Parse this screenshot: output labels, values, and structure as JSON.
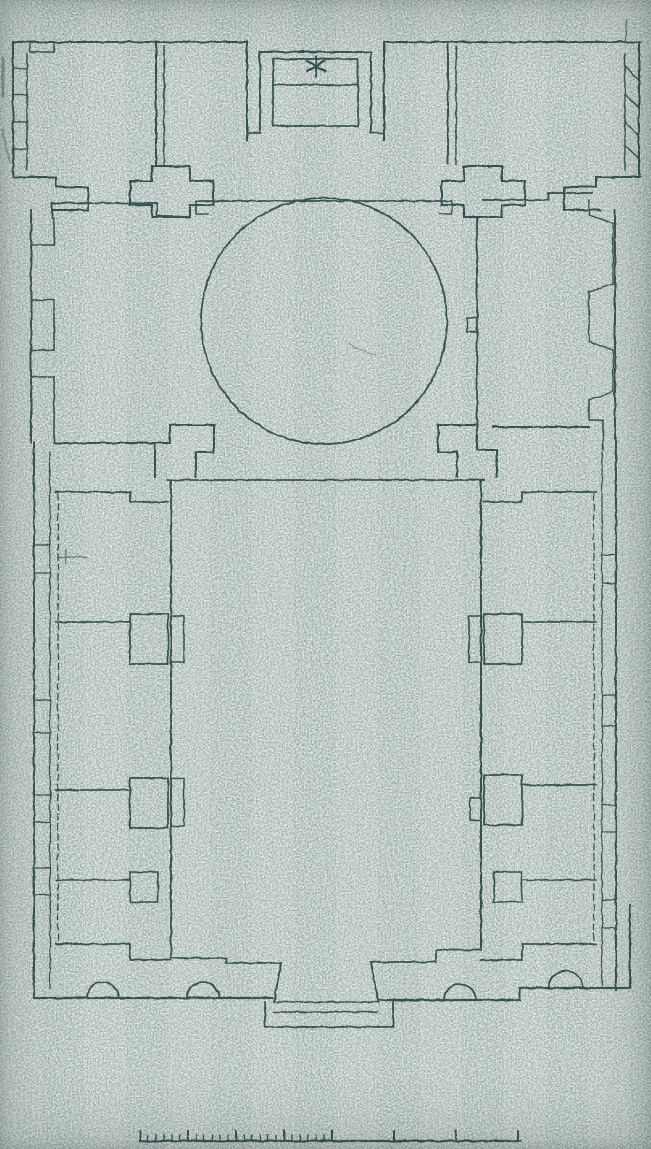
{
  "meta": {
    "document_type": "scanned architectural floor plan",
    "plan_features": "domed hall with projecting apse, courtyard flanked by cell rooms, entrance portal, graphic scale bar",
    "apse_mark_symbol": "asterisk"
  },
  "palette": {
    "paper": "#b4bfbc",
    "paper_light": "#e6ebe8",
    "paper_dark": "#546662",
    "ink": "#2d4845"
  },
  "drawing": {
    "width": 651,
    "height": 1149,
    "elements": [
      {
        "n": "top-wall-left",
        "k": "path",
        "d": "M13,42 H247"
      },
      {
        "n": "top-wall-right",
        "k": "path",
        "d": "M384,42 H640"
      },
      {
        "n": "wall-notch-nw",
        "k": "path",
        "d": "M30,42 V52 H54 V44",
        "w": 1.4
      },
      {
        "n": "left-band-outer-edge",
        "k": "path",
        "d": "M13,42 V177"
      },
      {
        "n": "left-band-inner-edge",
        "k": "path",
        "d": "M27,54 V170",
        "w": 1.5
      },
      {
        "n": "left-band-niche-1",
        "k": "path",
        "d": "M13,68 H27",
        "w": 1.4
      },
      {
        "n": "left-band-niche-2",
        "k": "path",
        "d": "M13,95 H27",
        "w": 1.4
      },
      {
        "n": "left-band-niche-3",
        "k": "path",
        "d": "M13,122 H27",
        "w": 1.4
      },
      {
        "n": "left-band-niche-4",
        "k": "path",
        "d": "M13,149 H27",
        "w": 1.4
      },
      {
        "n": "room-nw-east-wall-a",
        "k": "path",
        "d": "M156,42 V164"
      },
      {
        "n": "room-nw-east-wall-b",
        "k": "path",
        "d": "M164,46 V164",
        "w": 1.5
      },
      {
        "n": "pier-band-nw",
        "k": "path",
        "d": "M13,177 H56 V187 H88 V210 H52"
      },
      {
        "n": "pier-cross-left",
        "k": "path",
        "d": "M152,166 H190 V181 H213 V205 H190 V217 H152 V205 H130 V181 H152 Z"
      },
      {
        "n": "hall-north-wall-left",
        "k": "path",
        "d": "M52,218 V203 H157 V216 H180",
        "w": 1.8
      },
      {
        "n": "hall-north-wall-center",
        "k": "path",
        "d": "M196,201 H452",
        "w": 1.8
      },
      {
        "n": "hall-north-notch-left",
        "k": "path",
        "d": "M196,201 V214 H208",
        "w": 1.5
      },
      {
        "n": "hall-north-notch-right",
        "k": "path",
        "d": "M440,214 H452 V201",
        "w": 1.5
      },
      {
        "n": "hall-north-wall-right",
        "k": "path",
        "d": "M483,200 H548 V193 H592",
        "w": 1.8
      },
      {
        "n": "apse-outer-wall-left",
        "k": "path",
        "d": "M247,140 V42"
      },
      {
        "n": "apse-outer-wall-right",
        "k": "path",
        "d": "M384,140 V42"
      },
      {
        "n": "apse-outer-bottom-left",
        "k": "path",
        "d": "M247,133 H261",
        "w": 1.6
      },
      {
        "n": "apse-outer-bottom-right",
        "k": "path",
        "d": "M371,133 H384",
        "w": 1.6
      },
      {
        "n": "apse-middle-wall",
        "k": "path",
        "d": "M260,133 V52 H371 V133"
      },
      {
        "n": "apse-inner-recess",
        "k": "path",
        "d": "M273,59 H358 V126 H273 Z",
        "w": 1.8
      },
      {
        "n": "apse-inner-divider",
        "k": "path",
        "d": "M273,85 H358",
        "w": 1.8
      },
      {
        "n": "apse-star-mark-v",
        "k": "path",
        "d": "M316,56 V76",
        "w": 2.2
      },
      {
        "n": "apse-star-mark-d1",
        "k": "path",
        "d": "M307,61 L325,71",
        "w": 2.2
      },
      {
        "n": "apse-star-mark-d2",
        "k": "path",
        "d": "M307,71 L325,61",
        "w": 2.2
      },
      {
        "n": "room-ne-west-wall-a",
        "k": "path",
        "d": "M448,42 V164"
      },
      {
        "n": "room-ne-west-wall-b",
        "k": "path",
        "d": "M456,46 V164",
        "w": 1.5
      },
      {
        "n": "pier-cross-right",
        "k": "path",
        "d": "M464,166 H502 V181 H525 V205 H502 V217 H464 V205 H442 V181 H464 Z"
      },
      {
        "n": "pier-band-ne",
        "k": "path",
        "d": "M640,177 H596 V187 H564 V210 H600"
      },
      {
        "n": "right-band-outer-edge",
        "k": "path",
        "d": "M639,42 V177"
      },
      {
        "n": "right-band-inner-edge",
        "k": "path",
        "d": "M625,54 V170",
        "w": 1.5
      },
      {
        "n": "right-band-niche-1",
        "k": "path",
        "d": "M625,66 L639,80",
        "w": 1.4
      },
      {
        "n": "right-band-niche-2",
        "k": "path",
        "d": "M625,94 L639,108",
        "w": 1.4
      },
      {
        "n": "right-band-niche-3",
        "k": "path",
        "d": "M625,122 L639,136",
        "w": 1.4
      },
      {
        "n": "right-band-niche-4",
        "k": "path",
        "d": "M625,146 L639,158",
        "w": 1.4
      },
      {
        "n": "wall-stub-ne",
        "k": "path",
        "d": "M626,20 V42",
        "w": 1.5,
        "o": 0.7
      },
      {
        "n": "dome-circle",
        "k": "circle",
        "cx": 324,
        "cy": 321,
        "r": 123,
        "w": 1.8
      },
      {
        "n": "hall-west-outer-wall",
        "k": "path",
        "d": "M31,210 V442"
      },
      {
        "n": "hall-west-inner-a",
        "k": "path",
        "d": "M54,218 V245",
        "w": 1.6
      },
      {
        "n": "hall-west-inner-b",
        "k": "path",
        "d": "M54,300 V350",
        "w": 1.6
      },
      {
        "n": "hall-west-inner-c",
        "k": "path",
        "d": "M54,377 V442",
        "w": 1.6
      },
      {
        "n": "hall-west-niche1-top",
        "k": "path",
        "d": "M54,245 H31",
        "w": 1.4
      },
      {
        "n": "hall-west-niche1-bottom",
        "k": "path",
        "d": "M54,300 H31",
        "w": 1.4
      },
      {
        "n": "hall-west-niche2-top",
        "k": "path",
        "d": "M54,350 H31",
        "w": 1.4
      },
      {
        "n": "hall-west-niche2-bottom",
        "k": "path",
        "d": "M54,377 H31",
        "w": 1.4
      },
      {
        "n": "hall-east-aisle-wall",
        "k": "path",
        "d": "M477,218 V423",
        "w": 1.8
      },
      {
        "n": "hall-east-aisle-pier",
        "k": "path",
        "d": "M477,318 H467 V332 H477",
        "w": 1.5
      },
      {
        "n": "hall-east-inner-a",
        "k": "path",
        "d": "M589,200 V215",
        "w": 1.6
      },
      {
        "n": "hall-east-inner-b",
        "k": "path",
        "d": "M589,292 V342",
        "w": 1.6
      },
      {
        "n": "hall-east-inner-c",
        "k": "path",
        "d": "M589,400 V420",
        "w": 1.6
      },
      {
        "n": "hall-east-niche1-top",
        "k": "path",
        "d": "M589,215 L613,223",
        "w": 1.4
      },
      {
        "n": "hall-east-niche1-side",
        "k": "path",
        "d": "M613,223 V284",
        "w": 1.4
      },
      {
        "n": "hall-east-niche1-bottom",
        "k": "path",
        "d": "M613,284 L589,292",
        "w": 1.4
      },
      {
        "n": "hall-east-niche2-top",
        "k": "path",
        "d": "M589,342 L613,350",
        "w": 1.4
      },
      {
        "n": "hall-east-niche2-side",
        "k": "path",
        "d": "M613,350 V392",
        "w": 1.4
      },
      {
        "n": "hall-east-niche2-bottom",
        "k": "path",
        "d": "M613,392 L589,400",
        "w": 1.4
      },
      {
        "n": "hall-east-outer-wall",
        "k": "path",
        "d": "M615,210 V438"
      },
      {
        "n": "hall-south-wall-left",
        "k": "path",
        "d": "M54,443 H163"
      },
      {
        "n": "hall-south-wall-right",
        "k": "path",
        "d": "M493,427 H589"
      },
      {
        "n": "corner-step-se-hall",
        "k": "path",
        "d": "M589,420 H603 V450",
        "w": 1.6
      },
      {
        "n": "pier-courtyard-nw",
        "k": "path",
        "d": "M155,477 V443 H170 V425 H214 V452 H196 V477"
      },
      {
        "n": "pier-courtyard-ne",
        "k": "path",
        "d": "M497,477 V450 H477 V425 H438 V452 H457 V477"
      },
      {
        "n": "courtyard-north-wall",
        "k": "path",
        "d": "M168,480 H484",
        "w": 1.8
      },
      {
        "n": "courtyard-west-wall",
        "k": "path",
        "d": "M171,480 V948"
      },
      {
        "n": "courtyard-west-pier-1",
        "k": "path",
        "d": "M171,616 H184 V662 H171",
        "w": 1.6
      },
      {
        "n": "courtyard-west-pier-2",
        "k": "path",
        "d": "M171,778 H184 V826 H171",
        "w": 1.6
      },
      {
        "n": "courtyard-east-wall",
        "k": "path",
        "d": "M481,480 V948"
      },
      {
        "n": "courtyard-east-pier-1",
        "k": "path",
        "d": "M481,616 H469 V662 H481",
        "w": 1.6
      },
      {
        "n": "courtyard-east-pier-2",
        "k": "path",
        "d": "M481,798 H470 V820 H481",
        "w": 1.6
      },
      {
        "n": "wing-left-outer-edge",
        "k": "path",
        "d": "M34,442 V998"
      },
      {
        "n": "wing-left-inner-edge",
        "k": "path",
        "d": "M50,452 V988",
        "w": 1.3
      },
      {
        "n": "wing-left-niche-1a",
        "k": "path",
        "d": "M34,545 H50",
        "w": 1.3
      },
      {
        "n": "wing-left-niche-1b",
        "k": "path",
        "d": "M34,573 H50",
        "w": 1.3
      },
      {
        "n": "wing-left-niche-2a",
        "k": "path",
        "d": "M34,700 H50",
        "w": 1.3
      },
      {
        "n": "wing-left-niche-2b",
        "k": "path",
        "d": "M34,733 H50",
        "w": 1.3
      },
      {
        "n": "wing-left-niche-3a",
        "k": "path",
        "d": "M34,795 H50",
        "w": 1.3
      },
      {
        "n": "wing-left-niche-3b",
        "k": "path",
        "d": "M34,822 H50",
        "w": 1.3
      },
      {
        "n": "wing-left-niche-4a",
        "k": "path",
        "d": "M34,868 H50",
        "w": 1.3
      },
      {
        "n": "wing-left-niche-4b",
        "k": "path",
        "d": "M34,895 H50",
        "w": 1.3
      },
      {
        "n": "wing-left-top-wall",
        "k": "path",
        "d": "M56,492 H130 V502 H168",
        "w": 1.8
      },
      {
        "n": "wing-left-divider-1",
        "k": "path",
        "d": "M56,622 H130",
        "w": 1.8
      },
      {
        "n": "wing-left-pier-1",
        "k": "path",
        "d": "M130,614 H168 V664 H130 Z",
        "w": 1.8
      },
      {
        "n": "wing-left-divider-2",
        "k": "path",
        "d": "M56,790 H130",
        "w": 1.8
      },
      {
        "n": "wing-left-pier-2",
        "k": "path",
        "d": "M130,778 H168 V828 H130 Z",
        "w": 1.8
      },
      {
        "n": "wing-left-divider-3",
        "k": "path",
        "d": "M56,880 H130",
        "w": 1.6
      },
      {
        "n": "wing-left-pier-3",
        "k": "path",
        "d": "M130,872 H158 V902 H130 Z",
        "w": 1.6
      },
      {
        "n": "wing-left-bottom-wall",
        "k": "path",
        "d": "M56,944 H130 V960 H171",
        "w": 1.8
      },
      {
        "n": "wing-left-gallery-line",
        "k": "path",
        "d": "M58,494 V942",
        "w": 1.3,
        "da": "6 4"
      },
      {
        "n": "wing-right-outer-edge",
        "k": "path",
        "d": "M616,438 V990"
      },
      {
        "n": "wing-right-inner-edge",
        "k": "path",
        "d": "M602,452 V985",
        "w": 1.3
      },
      {
        "n": "wing-right-niche-1a",
        "k": "path",
        "d": "M602,555 H616",
        "w": 1.3
      },
      {
        "n": "wing-right-niche-1b",
        "k": "path",
        "d": "M602,583 H616",
        "w": 1.3
      },
      {
        "n": "wing-right-niche-2a",
        "k": "path",
        "d": "M602,695 H616",
        "w": 1.3
      },
      {
        "n": "wing-right-niche-2b",
        "k": "path",
        "d": "M602,726 H616",
        "w": 1.3
      },
      {
        "n": "wing-right-niche-3a",
        "k": "path",
        "d": "M602,805 H616",
        "w": 1.3
      },
      {
        "n": "wing-right-niche-3b",
        "k": "path",
        "d": "M602,832 H616",
        "w": 1.3
      },
      {
        "n": "wing-right-niche-4a",
        "k": "path",
        "d": "M602,900 H616",
        "w": 1.3
      },
      {
        "n": "wing-right-niche-4b",
        "k": "path",
        "d": "M602,928 H616",
        "w": 1.3
      },
      {
        "n": "wing-right-top-wall",
        "k": "path",
        "d": "M596,492 H522 V502 H484",
        "w": 1.8
      },
      {
        "n": "wing-right-divider-1",
        "k": "path",
        "d": "M596,622 H522",
        "w": 1.8
      },
      {
        "n": "wing-right-pier-1",
        "k": "path",
        "d": "M522,614 H484 V664 H522 Z",
        "w": 1.8
      },
      {
        "n": "wing-right-divider-2",
        "k": "path",
        "d": "M596,785 H522",
        "w": 1.8
      },
      {
        "n": "wing-right-pier-2",
        "k": "path",
        "d": "M522,775 H484 V825 H522 Z",
        "w": 1.8
      },
      {
        "n": "wing-right-divider-3",
        "k": "path",
        "d": "M596,880 H522",
        "w": 1.6
      },
      {
        "n": "wing-right-pier-3",
        "k": "path",
        "d": "M522,872 H494 V902 H522 Z",
        "w": 1.6
      },
      {
        "n": "wing-right-bottom-wall",
        "k": "path",
        "d": "M596,944 H522 V960 H481",
        "w": 1.8
      },
      {
        "n": "wing-right-gallery-line",
        "k": "path",
        "d": "M594,494 V942",
        "w": 1.3,
        "da": "6 4"
      },
      {
        "n": "courtyard-south-step-left",
        "k": "path",
        "d": "M171,948 V958 H226 V963 H281",
        "w": 1.8
      },
      {
        "n": "courtyard-south-step-right",
        "k": "path",
        "d": "M481,948 V950 H436 V962 H371",
        "w": 1.8
      },
      {
        "n": "portal-jamb-left",
        "k": "path",
        "d": "M281,963 L274,1002"
      },
      {
        "n": "portal-jamb-right",
        "k": "path",
        "d": "M371,962 L378,1002"
      },
      {
        "n": "facade-wall-left",
        "k": "path",
        "d": "M34,998 H272",
        "w": 2.2
      },
      {
        "n": "facade-wall-right",
        "k": "path",
        "d": "M380,1000 H520 V988 H630",
        "w": 2.2
      },
      {
        "n": "facade-corner-right",
        "k": "path",
        "d": "M630,988 V905",
        "w": 2
      },
      {
        "n": "portal-outer",
        "k": "path",
        "d": "M265,1002 V1027 H393 V1002",
        "w": 1.8
      },
      {
        "n": "portal-threshold",
        "k": "path",
        "d": "M274,1002 H378",
        "w": 1.5
      },
      {
        "n": "portal-inner-line",
        "k": "path",
        "d": "M274,1012 H378",
        "w": 1.5
      },
      {
        "n": "facade-column-1",
        "k": "path",
        "d": "M87,998 A16,16 0 0 1 119,998",
        "w": 1.8
      },
      {
        "n": "facade-column-2",
        "k": "path",
        "d": "M187,998 A16,16 0 0 1 219,998",
        "w": 1.8
      },
      {
        "n": "facade-column-3",
        "k": "path",
        "d": "M444,1000 A16,16 0 0 1 476,1000",
        "w": 1.8
      },
      {
        "n": "facade-column-4",
        "k": "path",
        "d": "M549,988 A17,17 0 0 1 583,988",
        "w": 1.8
      },
      {
        "n": "scalebar-line",
        "k": "path",
        "d": "M140,1141 H521",
        "w": 2.2
      },
      {
        "n": "scan-smudge-1",
        "k": "path",
        "d": "M3,58 V96",
        "w": 3,
        "o": 0.45
      },
      {
        "n": "scan-smudge-2",
        "k": "path",
        "d": "M2,130 L10,162",
        "w": 2.5,
        "o": 0.35
      },
      {
        "n": "scan-mark-1",
        "k": "path",
        "d": "M58,557 H86",
        "w": 1.5,
        "o": 0.6
      },
      {
        "n": "scan-mark-2",
        "k": "path",
        "d": "M66,551 V564",
        "w": 1.5,
        "o": 0.6
      },
      {
        "n": "scan-mark-3",
        "k": "path",
        "d": "M348,344 L376,356",
        "w": 1.2,
        "o": 0.45
      }
    ],
    "scalebar": {
      "y": 1141,
      "minor": {
        "from": 140,
        "to": 332,
        "step": 8,
        "h": 6
      },
      "major": {
        "xs": [
          140,
          188,
          236,
          284,
          332,
          394,
          456,
          518
        ],
        "h": 10
      }
    }
  }
}
